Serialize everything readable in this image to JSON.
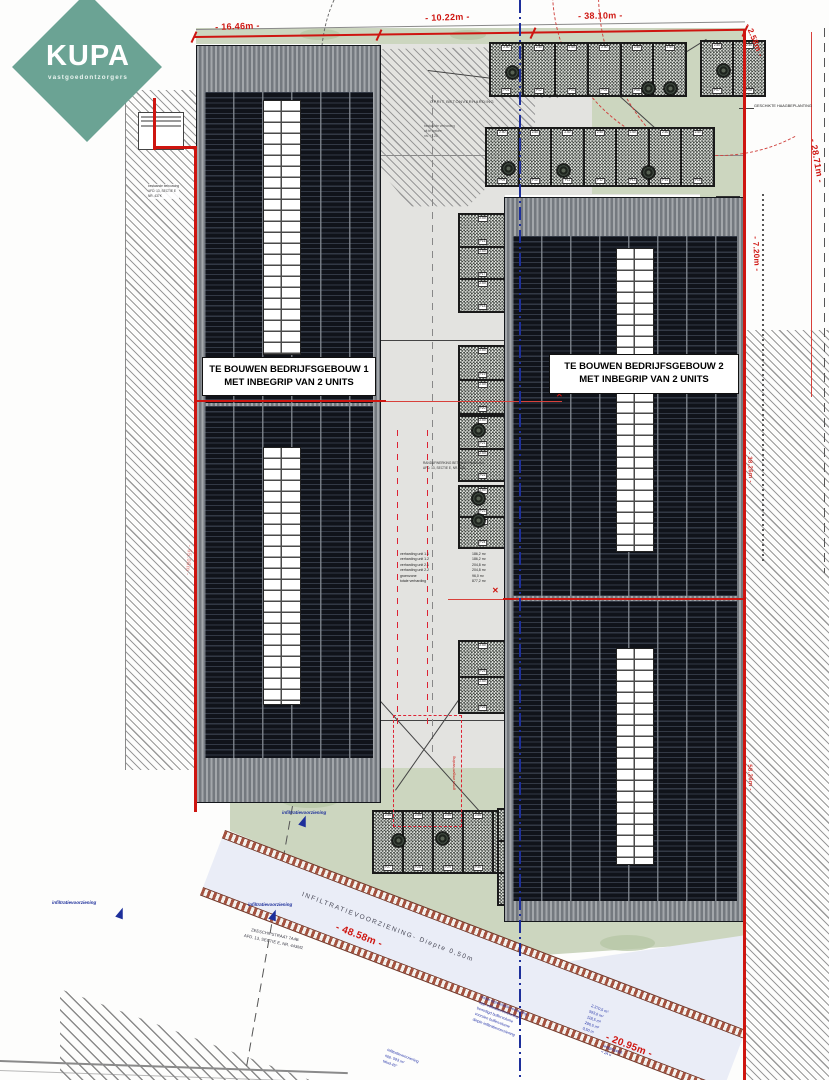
{
  "logo": {
    "brand": "KUPA",
    "tagline": "vastgoedontzorgers",
    "color": "#6ba394"
  },
  "buildings": {
    "b1": {
      "line1": "TE BOUWEN BEDRIJFSGEBOUW 1",
      "line2": "MET INBEGRIP VAN 2 UNITS"
    },
    "b2": {
      "line1": "TE BOUWEN BEDRIJFSGEBOUW 2",
      "line2": "MET INBEGRIP VAN 2 UNITS"
    }
  },
  "dims": {
    "top1": "- 16.46m -",
    "top2": "- 10.22m -",
    "top3": "- 38.10m -",
    "right_top": "- 2.58m -",
    "right_upper": "- 28.71m -",
    "right_mid": "- 7.20m -",
    "right_low": "- 38.26m -",
    "right_lower": "- 58.26m -",
    "left_mid": "- 65.06m -",
    "infiltration": "- 48.58m -",
    "pond": "- 20.95m -"
  },
  "labels": {
    "oprit": "OPRIT BETONVERHARDING",
    "beplanting": "GESCHIKTE HAAGBEPLANTING",
    "infiltration_strip": "INFILTRATIEVOORZIENING-   Diepte 0,50m",
    "infiltration_small": "infiltratievoorziening",
    "address1": "ZEESCHIPSTRAAT 7A4B",
    "address2": "AFD. 13, SECTIE E, NR. 443M2"
  },
  "clusters": [
    {
      "name": "legend-left",
      "x": 400,
      "y": 552,
      "rot": 0,
      "color": "#222",
      "size": 3.5,
      "lines": [
        "verharding unit 1.1",
        "verharding unit 1.2",
        "verharding unit 2.1",
        "verharding unit 2.2",
        "groenzone",
        "totale verharding"
      ]
    },
    {
      "name": "legend-values",
      "x": 472,
      "y": 552,
      "rot": 0,
      "color": "#222",
      "size": 3.5,
      "lines": [
        "186,2 m²",
        "186,2 m²",
        "204,8 m²",
        "204,8 m²",
        "96,0 m²",
        "877,2 m²"
      ]
    },
    {
      "name": "corridor-note",
      "x": 423,
      "y": 461,
      "rot": 0,
      "color": "#333",
      "size": 3.2,
      "lines": [
        "RANDAFWERKING BETONVERHARDING",
        "AFD. 13, SECTIE E, NR. 438L"
      ]
    },
    {
      "name": "hatch-note",
      "x": 424,
      "y": 124,
      "rot": 0,
      "color": "#555",
      "size": 3.2,
      "lines": [
        "bestaande verharding",
        "uit te breken",
        "niv. +1.25"
      ]
    },
    {
      "name": "left-note",
      "x": 148,
      "y": 184,
      "rot": 0,
      "color": "#333",
      "size": 3.2,
      "bg": 1,
      "lines": [
        "bestaande bebouwing",
        "AFD. 13, SECTIE E",
        "NR. 437K"
      ]
    },
    {
      "name": "pond-note-a",
      "x": 482,
      "y": 995,
      "rot": 21,
      "color": "#2433a8",
      "size": 3.8,
      "lines": [
        "totale oppervlakte verharding",
        "opp. infiltratievoorziening",
        "benodigd buffervolume",
        "voorzien buffervolume",
        "diepte infiltratievoorziening"
      ]
    },
    {
      "name": "pond-note-b",
      "x": 592,
      "y": 1004,
      "rot": 21,
      "color": "#2433a8",
      "size": 3.8,
      "lines": [
        "2.370,5 m²",
        "593,0 m²",
        "118,5 m³",
        "296,5 m³",
        "0,50 m"
      ]
    },
    {
      "name": "pond-note-c",
      "x": 388,
      "y": 1048,
      "rot": 21,
      "color": "#2433a8",
      "size": 3.8,
      "lines": [
        "infiltratievoorziening",
        "opp. 593 m²",
        "talud 45°"
      ]
    },
    {
      "name": "pond-note-d",
      "x": 604,
      "y": 1044,
      "rot": 21,
      "color": "#2433a8",
      "size": 3.8,
      "lines": [
        "ledigingstijd",
        "< 24 u"
      ]
    },
    {
      "name": "verge-note",
      "x": 452,
      "y": 790,
      "rot": -90,
      "color": "#ce1510",
      "size": 3.6,
      "lines": [
        "grens wegverharding"
      ]
    },
    {
      "name": "peil-note",
      "x": 566,
      "y": 382,
      "rot": 0,
      "color": "#ce1510",
      "size": 3.2,
      "lines": [
        "+8.35",
        "+8.20"
      ]
    }
  ],
  "site": {
    "stall_chip": "2.50",
    "stall_prefix": "P",
    "stall_groups": [
      {
        "x": 489,
        "y": 42,
        "w": 196,
        "h": 53,
        "n": 6,
        "dir": "h"
      },
      {
        "x": 700,
        "y": 40,
        "w": 64,
        "h": 55,
        "n": 2,
        "dir": "h"
      },
      {
        "x": 485,
        "y": 127,
        "w": 228,
        "h": 58,
        "n": 7,
        "dir": "h"
      },
      {
        "x": 458,
        "y": 213,
        "w": 47,
        "h": 98,
        "n": 3,
        "dir": "v"
      },
      {
        "x": 458,
        "y": 345,
        "w": 47,
        "h": 68,
        "n": 2,
        "dir": "v"
      },
      {
        "x": 458,
        "y": 415,
        "w": 47,
        "h": 65,
        "n": 2,
        "dir": "v"
      },
      {
        "x": 458,
        "y": 485,
        "w": 47,
        "h": 62,
        "n": 2,
        "dir": "v"
      },
      {
        "x": 458,
        "y": 640,
        "w": 47,
        "h": 72,
        "n": 2,
        "dir": "v"
      },
      {
        "x": 372,
        "y": 810,
        "w": 150,
        "h": 62,
        "n": 5,
        "dir": "h"
      },
      {
        "x": 497,
        "y": 808,
        "w": 24,
        "h": 96,
        "n": 3,
        "dir": "v"
      }
    ],
    "trees": [
      [
        512,
        72
      ],
      [
        648,
        88
      ],
      [
        670,
        88
      ],
      [
        723,
        70
      ],
      [
        508,
        168
      ],
      [
        563,
        170
      ],
      [
        648,
        172
      ],
      [
        478,
        430
      ],
      [
        478,
        498
      ],
      [
        478,
        520
      ],
      [
        727,
        300
      ],
      [
        727,
        345
      ],
      [
        398,
        840
      ],
      [
        442,
        838
      ]
    ],
    "skylights": [
      {
        "x": 263,
        "y": 100,
        "w": 36,
        "h": 253
      },
      {
        "x": 263,
        "y": 447,
        "w": 36,
        "h": 256
      },
      {
        "x": 616,
        "y": 248,
        "w": 36,
        "h": 302
      },
      {
        "x": 616,
        "y": 648,
        "w": 36,
        "h": 215
      }
    ]
  }
}
